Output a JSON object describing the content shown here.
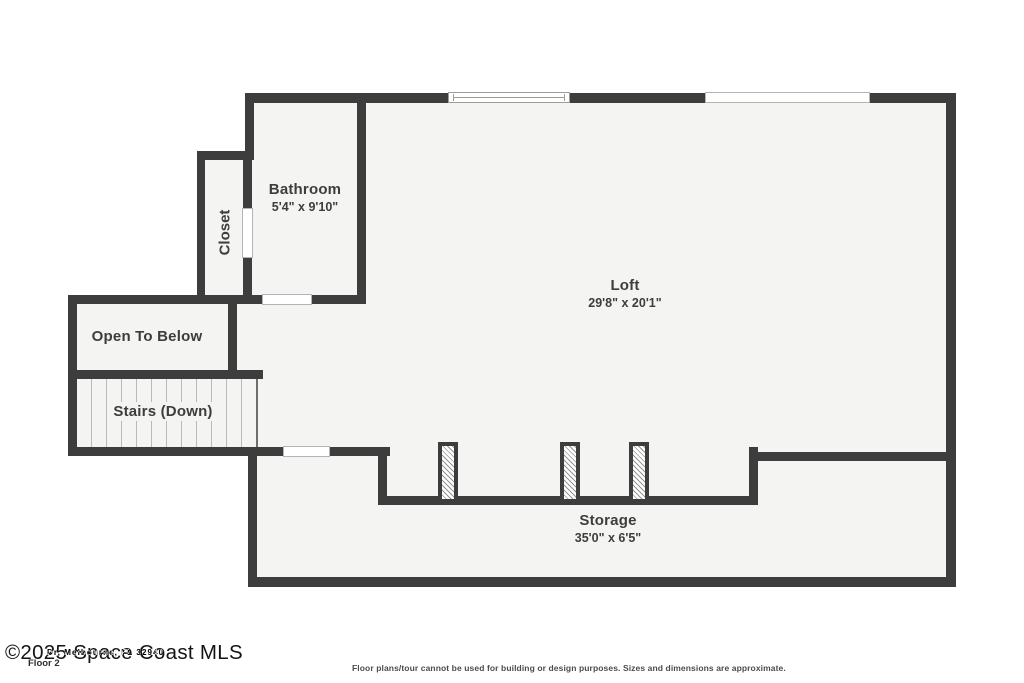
{
  "colors": {
    "background": "#ffffff",
    "wall": "#3d3d3d",
    "room_fill": "#f4f4f3",
    "text": "#3d3d3d",
    "tread_line": "#b9b9b9"
  },
  "rooms": {
    "bathroom": {
      "name": "Bathroom",
      "dims": "5'4\" x 9'10\""
    },
    "closet": {
      "name": "Closet"
    },
    "loft": {
      "name": "Loft",
      "dims": "29'8\" x 20'1\""
    },
    "open_to_below": {
      "name": "Open To Below"
    },
    "stairs": {
      "name": "Stairs (Down)"
    },
    "storage": {
      "name": "Storage",
      "dims": "35'0\" x 6'5\""
    }
  },
  "footer": {
    "watermark": "©2025 Space Coast MLS",
    "watermark_overlay": "Dr, Melbourne, FL 32940",
    "floor_label": "Floor 2",
    "disclaimer": "Floor plans/tour cannot be used for building or design purposes. Sizes and dimensions are approximate."
  }
}
